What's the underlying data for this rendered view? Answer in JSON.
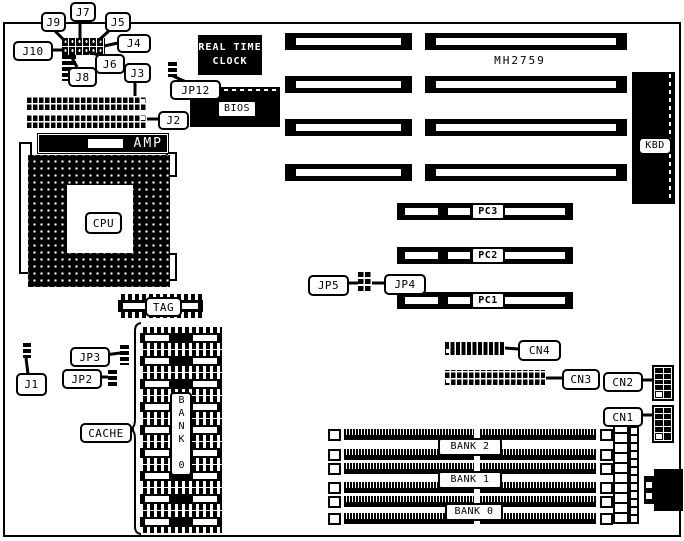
{
  "board": {
    "asic_label": "MH2759",
    "rtc_line1": "REAL TIME",
    "rtc_line2": "CLOCK",
    "bios": "BIOS",
    "kbd": "KBD",
    "amp": "AMP",
    "cpu": "CPU",
    "tag": "TAG",
    "cache_bank_vertical": "BANK 0"
  },
  "callouts": {
    "j9": "J9",
    "j7": "J7",
    "j5": "J5",
    "j4": "J4",
    "j10": "J10",
    "j6": "J6",
    "j8": "J8",
    "j3": "J3",
    "j2": "J2",
    "jp12": "JP12",
    "jp5": "JP5",
    "jp4": "JP4",
    "jp3": "JP3",
    "jp2": "JP2",
    "j1": "J1",
    "cache": "CACHE",
    "cn4": "CN4",
    "cn3": "CN3",
    "cn2": "CN2",
    "cn1": "CN1"
  },
  "slots": {
    "pc": [
      "PC3",
      "PC2",
      "PC1"
    ],
    "memory_banks": [
      "BANK 2",
      "BANK 1",
      "BANK 0"
    ]
  },
  "colors": {
    "ink": "#000000",
    "paper": "#ffffff"
  }
}
